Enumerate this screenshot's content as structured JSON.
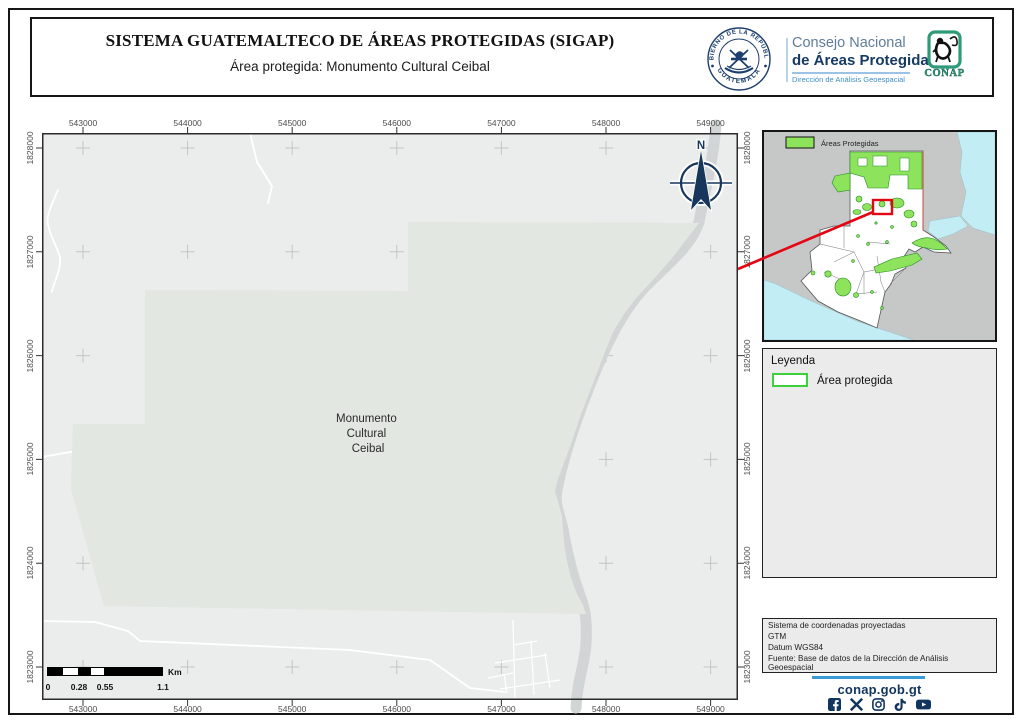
{
  "header": {
    "title": "SISTEMA GUATEMALTECO DE ÁREAS PROTEGIDAS  (SIGAP)",
    "subtitle": "Área protegida: Monumento Cultural Ceibal",
    "seal": {
      "top_text": "GOBIERNO DE LA REPÚBLICA",
      "bottom_text": "GUATEMALA"
    },
    "consejo": {
      "line1": "Consejo Nacional",
      "line2": "de Áreas Protegidas",
      "line3": "Dirección de Análisis Geoespacial"
    },
    "conap_label": "CONAP"
  },
  "map": {
    "x_ticks": [
      "543000",
      "544000",
      "545000",
      "546000",
      "547000",
      "548000",
      "549000"
    ],
    "y_ticks": [
      "1828000",
      "1827000",
      "1826000",
      "1825000",
      "1824000",
      "1823000"
    ],
    "area_label_lines": [
      "Monumento",
      "Cultural",
      "Ceibal"
    ],
    "north_label": "N",
    "scalebar": {
      "labels": [
        "0",
        "0.28",
        "0.55",
        "1.1"
      ],
      "unit": "Km"
    }
  },
  "overview": {
    "legend_label": "Áreas Protegidas"
  },
  "legend_box": {
    "title": "Leyenda",
    "item_label": "Área protegida"
  },
  "info_box": {
    "lines": [
      "Sistema de coordenadas proyectadas",
      "GTM",
      "Datum WGS84",
      "Fuente: Base de datos de la Dirección de Análisis Geoespacial"
    ]
  },
  "footer": {
    "domain": "conap.gob.gt",
    "icons": [
      "facebook-icon",
      "x-icon",
      "instagram-icon",
      "tiktok-icon",
      "youtube-icon"
    ]
  },
  "colors": {
    "protected_outline_green": "#3ad13a",
    "overview_green": "#8ee35c",
    "red_accent": "#e30613",
    "navy": "#12355f",
    "footer_blue": "#3b9bd4"
  }
}
